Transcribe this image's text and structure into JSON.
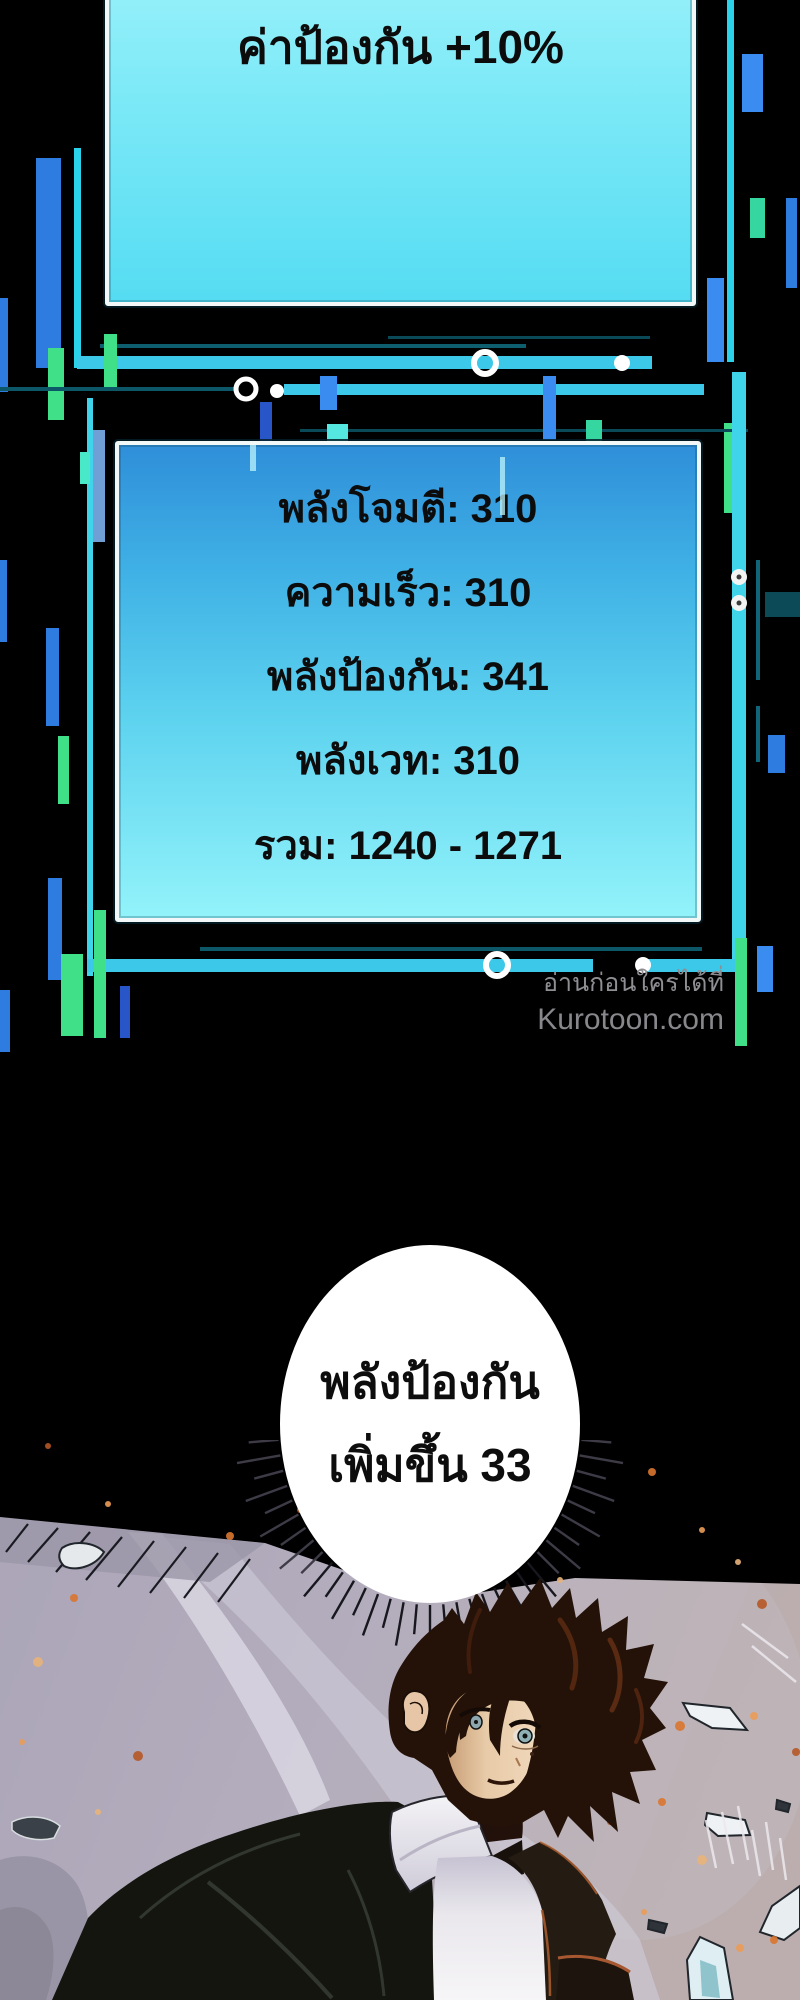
{
  "buff_panel": {
    "text": "ค่าป้องกัน +10%"
  },
  "stats_panel": {
    "lines": [
      "พลังโจมตี: 310",
      "ความเร็ว: 310",
      "พลังป้องกัน: 341",
      "พลังเวท: 310",
      "รวม: 1240 - 1271"
    ]
  },
  "watermark": {
    "line1": "อ่านก่อนใครได้ที่",
    "line2": "Kurotoon.com"
  },
  "speech_bubble": {
    "line1": "พลังป้องกัน",
    "line2": "เพิ่มขึ้น 33"
  },
  "colors": {
    "buff_panel_top": "#a0f3fb",
    "buff_panel_bottom": "#55dcf2",
    "stats_panel_top": "#2f8fd9",
    "stats_panel_bottom": "#93f3fa",
    "frame_cyan": "#3fd4ea",
    "glitch_blue": "#2e7ce0",
    "glitch_green": "#3fe087",
    "watermark_gray": "#8e8e93",
    "scene_sky": "#b2adbe",
    "ember_orange": "#d9752f",
    "bubble_white": "#ffffff"
  }
}
